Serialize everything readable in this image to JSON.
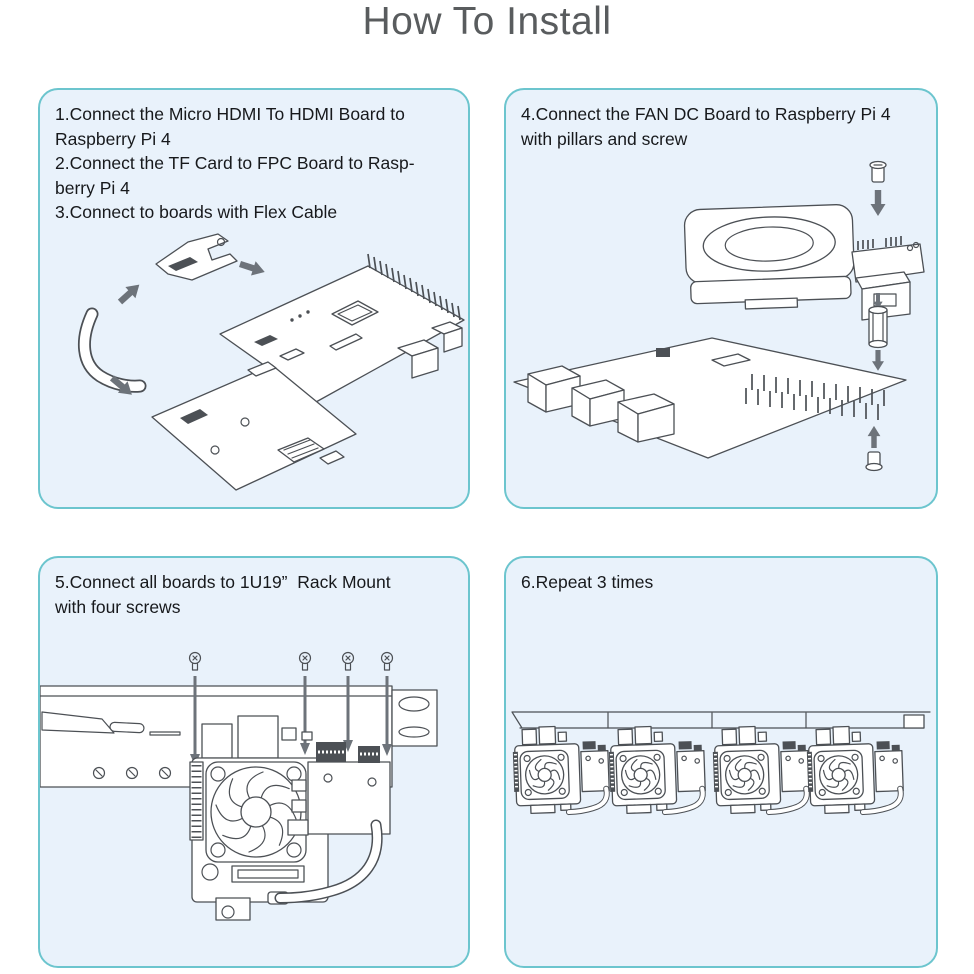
{
  "page": {
    "title": "How To Install"
  },
  "colors": {
    "panel_border": "#6cc5ce",
    "panel_background": "#e9f2fb",
    "instruction_text": "#17191c",
    "title_text": "#595c5e",
    "line_art": "#4c5055",
    "arrow": "#6d737a"
  },
  "panels": [
    {
      "lines": [
        "1.Connect the Micro HDMI To HDMI Board to",
        "Raspberry Pi 4",
        "2.Connect the TF Card to FPC Board to Rasp-",
        "berry Pi 4",
        "3.Connect to boards with Flex Cable"
      ]
    },
    {
      "lines": [
        "4.Connect the FAN DC Board to Raspberry Pi 4",
        "with pillars and screw"
      ]
    },
    {
      "lines": [
        "5.Connect all boards to 1U19”  Rack Mount",
        "with four screws"
      ]
    },
    {
      "lines": [
        "6.Repeat 3 times"
      ]
    }
  ]
}
